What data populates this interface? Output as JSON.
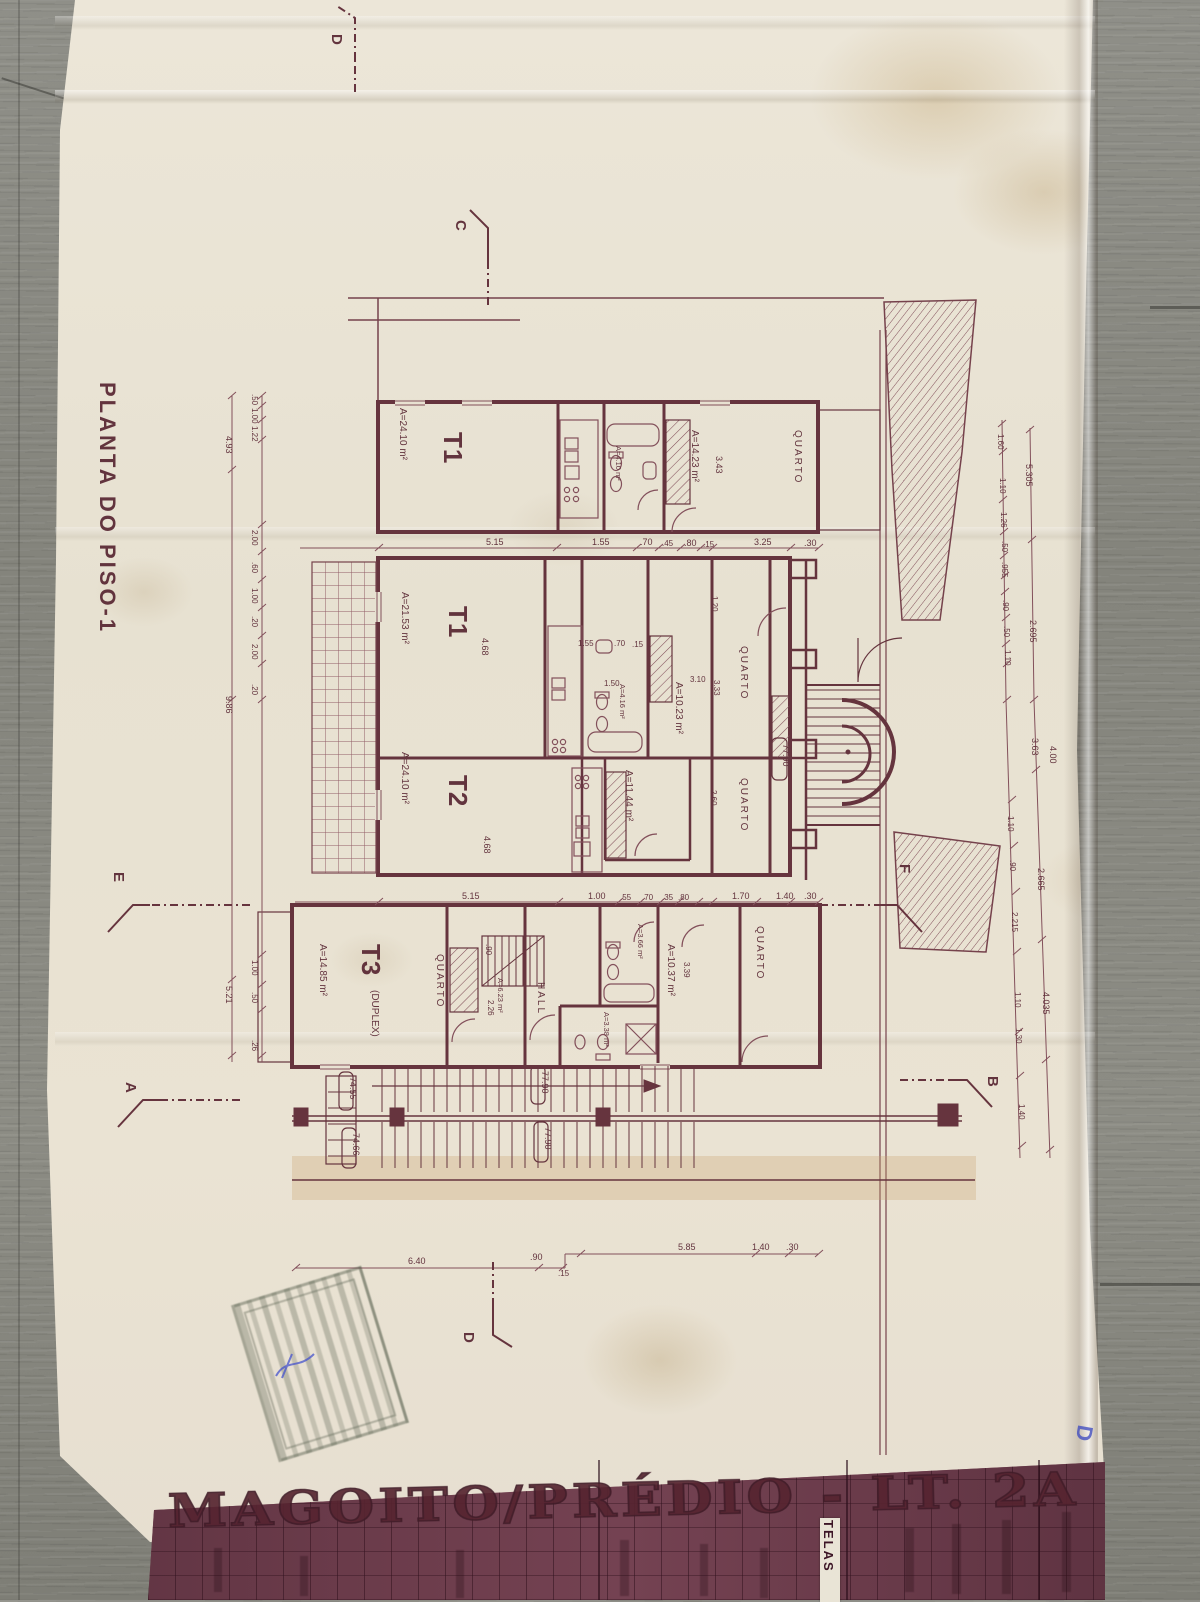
{
  "sheet": {
    "plan_title": "PLANTA DO PISO-1",
    "band_title": "MAGOITO/PRÉDIO - LT. 2A",
    "band_side_label": "TELAS",
    "handwritten_mark": "D"
  },
  "units": {
    "t1a": {
      "label": "T1",
      "area": "A=24.10 m²"
    },
    "t1b": {
      "label": "T1",
      "area": "A=21.53 m²"
    },
    "t2": {
      "label": "T2",
      "area": "A=24.10 m²"
    },
    "t3": {
      "label": "T3",
      "suffix": "(DUPLEX)",
      "area": "A=14.85 m²"
    }
  },
  "rooms": {
    "quarto": "QUARTO",
    "hall": "HALL"
  },
  "areas": {
    "bed_a": "A=14.23 m²",
    "bed_b": "A=10.23 m²",
    "bed_c": "A=11.44 m²",
    "bed_d": "A=10.37 m²",
    "bath_a": "A=4.10 m²",
    "bath_b": "A=4.16 m²",
    "bath_c": "A=3.66 m²",
    "wc": "A=3.38 m²",
    "stair": "A=6.23 m²"
  },
  "levels": {
    "upper": "77.90",
    "lower_a": "74.55",
    "lower_b": "74.66"
  },
  "sections": {
    "a": "A",
    "b": "B",
    "c": "C",
    "d": "D",
    "e": "E",
    "f": "F"
  },
  "dims": {
    "top": [
      "5.15",
      "1.55",
      ".70",
      ".45",
      ".80",
      ".15",
      "3.25",
      ".30"
    ],
    "mid": [
      "5.15",
      "1.00",
      ".55",
      ".70",
      ".35",
      ".80",
      "1.70",
      "1.40",
      ".30"
    ],
    "bottom": [
      "6.40",
      ".90",
      ".15",
      "5.85",
      "1.40",
      ".30"
    ],
    "left_inner": [
      ".50",
      "1.00",
      "1.22",
      "2.00",
      ".60",
      "1.00",
      ".20",
      "2.00",
      ".20",
      "1.00",
      ".50",
      ".26"
    ],
    "left_outer": [
      "4.93",
      "9.86",
      "5.21"
    ],
    "right_inner": [
      "1.60",
      "1.10",
      "1.26",
      ".50",
      ".955",
      ".90",
      ".50",
      "1.10",
      "1.10",
      ".90",
      "2.215",
      "1.10",
      "1.30",
      "1.40"
    ],
    "right_outer": [
      "5.305",
      "2.695",
      "3.63",
      "4.00",
      "2.665",
      "4.035"
    ],
    "interior": [
      "3.43",
      "4.68",
      "1.55",
      ".70",
      ".15",
      "1.50",
      "3.10",
      "3.33",
      "1.20",
      "2.60",
      "4.68",
      "3.39",
      ".90",
      "2.26"
    ]
  }
}
